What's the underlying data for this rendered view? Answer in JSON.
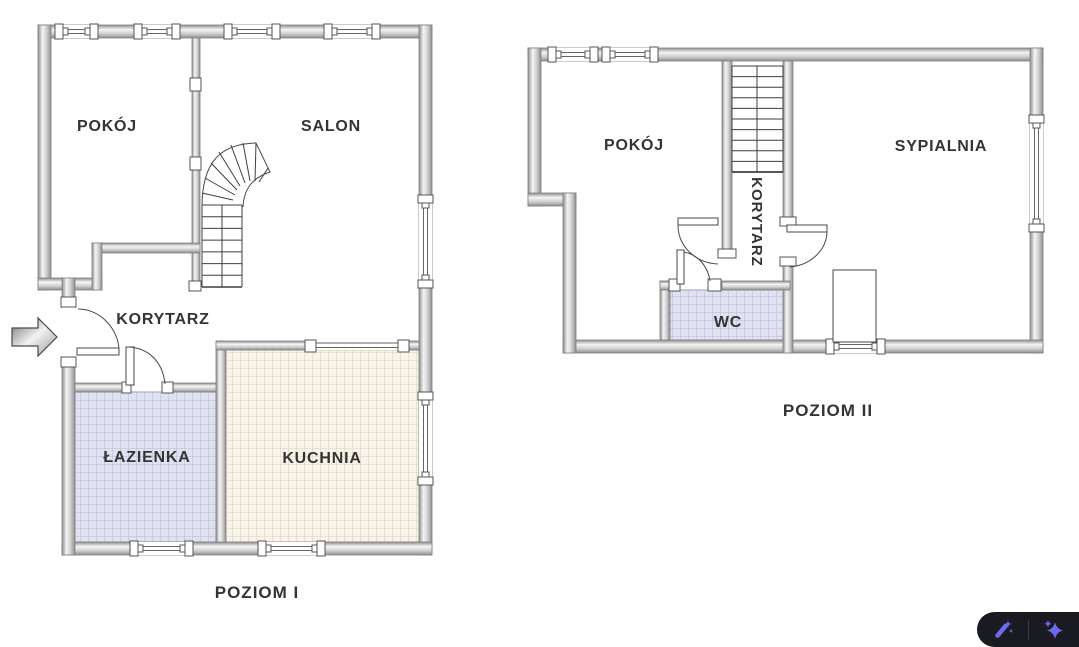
{
  "plans": {
    "level1": {
      "title": "POZIOM I",
      "rooms": {
        "pokoj": "POKÓJ",
        "salon": "SALON",
        "korytarz": "KORYTARZ",
        "lazienka": "ŁAZIENKA",
        "kuchnia": "KUCHNIA"
      }
    },
    "level2": {
      "title": "POZIOM II",
      "rooms": {
        "pokoj": "POKÓJ",
        "sypialnia": "SYPIALNIA",
        "korytarz": "KORYTARZ",
        "wc": "WC"
      }
    }
  },
  "icons": {
    "entrance_arrow": "entrance-arrow-icon",
    "toolbar": [
      "magic-wand-icon",
      "sparkles-icon"
    ]
  },
  "colors": {
    "background": "#ffffff",
    "wall_light": "#f5f5f5",
    "wall_mid": "#c9c9c9",
    "wall_dark": "#8f8f8f",
    "label_text": "#343434",
    "bath_tile": "#e0e2f1",
    "bath_tile_grid": "#b4b8d6",
    "kitchen_tile": "#f8f4e9",
    "kitchen_tile_grid": "#d9d1bc",
    "badge_background": "#191b21",
    "icon_blue": "#4f7df2",
    "icon_purple": "#8457f0"
  }
}
